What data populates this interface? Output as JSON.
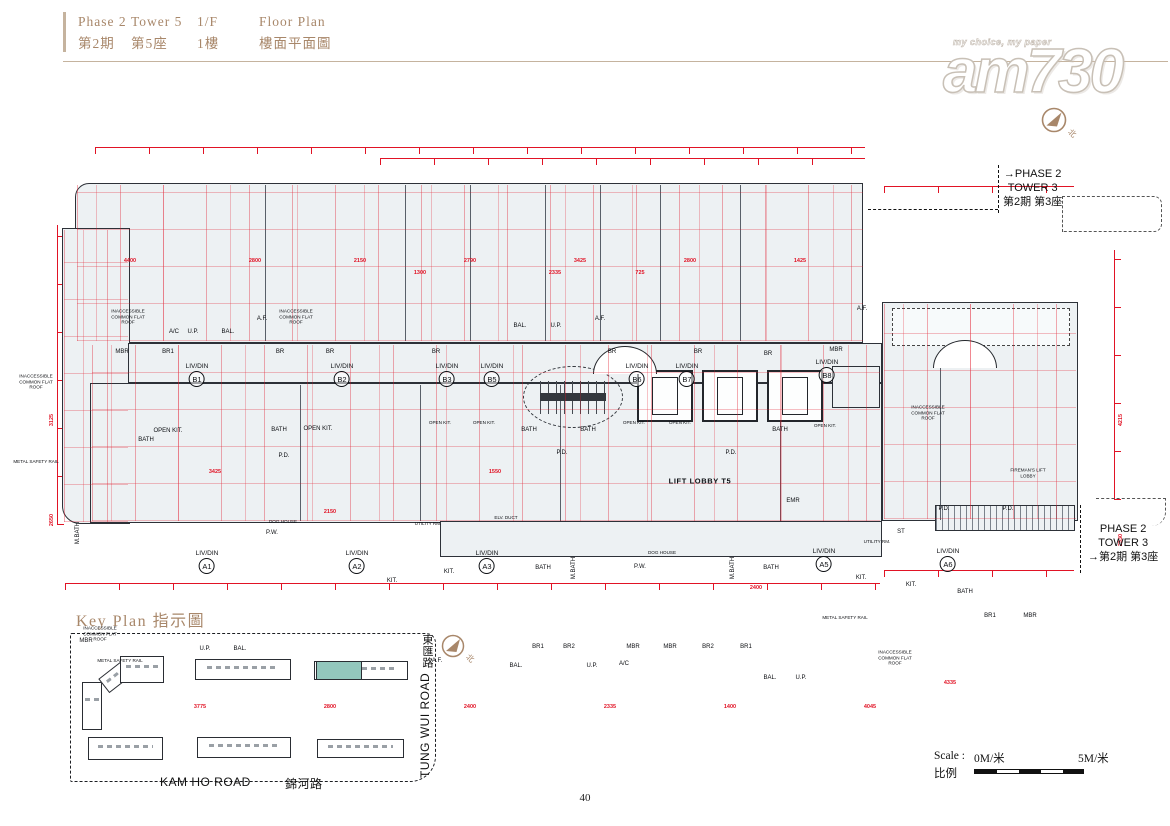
{
  "header": {
    "phase_en": "Phase 2",
    "tower_en": "Tower 5",
    "floor_en": "1/F",
    "plan_en": "Floor Plan",
    "phase_zh": "第2期",
    "tower_zh": "第5座",
    "floor_zh": "1樓",
    "plan_zh": "樓面平面圖"
  },
  "watermark": {
    "tagline": "my choice, my paper",
    "logo": "am730"
  },
  "compass": {
    "north": "北"
  },
  "plan": {
    "callout_top": {
      "l1": "PHASE 2",
      "l2": "TOWER 3",
      "l3": "第2期 第3座"
    },
    "callout_bottom": {
      "l1": "PHASE 2",
      "l2": "TOWER 3",
      "l3": "第2期 第3座"
    },
    "units": [
      {
        "r": "LIV/DIN",
        "id": "B1",
        "x": 197,
        "y": 243
      },
      {
        "r": "LIV/DIN",
        "id": "B2",
        "x": 342,
        "y": 243
      },
      {
        "r": "LIV/DIN",
        "id": "B3",
        "x": 447,
        "y": 243
      },
      {
        "r": "LIV/DIN",
        "id": "B5",
        "x": 492,
        "y": 243
      },
      {
        "r": "LIV/DIN",
        "id": "B6",
        "x": 637,
        "y": 243
      },
      {
        "r": "LIV/DIN",
        "id": "B7",
        "x": 687,
        "y": 243
      },
      {
        "r": "LIV/DIN",
        "id": "B8",
        "x": 827,
        "y": 239
      },
      {
        "r": "LIV/DIN",
        "id": "A1",
        "x": 207,
        "y": 430
      },
      {
        "r": "LIV/DIN",
        "id": "A2",
        "x": 357,
        "y": 430
      },
      {
        "r": "LIV/DIN",
        "id": "A3",
        "x": 487,
        "y": 430
      },
      {
        "r": "LIV/DIN",
        "id": "A5",
        "x": 824,
        "y": 428
      },
      {
        "r": "LIV/DIN",
        "id": "A6",
        "x": 948,
        "y": 428
      }
    ],
    "rooms": [
      {
        "t": "INACCESSIBLE COMMON FLAT ROOF",
        "x": 128,
        "y": 197,
        "c": "w"
      },
      {
        "t": "INACCESSIBLE COMMON FLAT ROOF",
        "x": 296,
        "y": 197,
        "c": "w"
      },
      {
        "t": "INACCESSIBLE COMMON FLAT ROOF",
        "x": 36,
        "y": 262,
        "c": "w"
      },
      {
        "t": "INACCESSIBLE COMMON FLAT ROOF",
        "x": 928,
        "y": 293,
        "c": "w"
      },
      {
        "t": "INACCESSIBLE COMMON FLAT ROOF",
        "x": 100,
        "y": 514,
        "c": "w"
      },
      {
        "t": "INACCESSIBLE COMMON FLAT ROOF",
        "x": 895,
        "y": 538,
        "c": "w"
      },
      {
        "t": "METAL SAFETY RAIL",
        "x": 36,
        "y": 342,
        "c": "w"
      },
      {
        "t": "METAL SAFETY RAIL",
        "x": 120,
        "y": 541,
        "c": "w"
      },
      {
        "t": "METAL SAFETY RAIL",
        "x": 845,
        "y": 498,
        "c": "w"
      },
      {
        "t": "A.F.",
        "x": 262,
        "y": 199
      },
      {
        "t": "A.F.",
        "x": 600,
        "y": 199
      },
      {
        "t": "A.F.",
        "x": 862,
        "y": 189
      },
      {
        "t": "A.F.",
        "x": 437,
        "y": 541
      },
      {
        "t": "A/C",
        "x": 174,
        "y": 212
      },
      {
        "t": "U.P.",
        "x": 193,
        "y": 212
      },
      {
        "t": "BAL.",
        "x": 228,
        "y": 212
      },
      {
        "t": "BAL.",
        "x": 520,
        "y": 206
      },
      {
        "t": "U.P.",
        "x": 556,
        "y": 206
      },
      {
        "t": "MBR",
        "x": 122,
        "y": 232
      },
      {
        "t": "BR1",
        "x": 168,
        "y": 232
      },
      {
        "t": "BR",
        "x": 280,
        "y": 232
      },
      {
        "t": "BR",
        "x": 330,
        "y": 232
      },
      {
        "t": "BR",
        "x": 436,
        "y": 232
      },
      {
        "t": "BR",
        "x": 612,
        "y": 232
      },
      {
        "t": "BR",
        "x": 698,
        "y": 232
      },
      {
        "t": "BR",
        "x": 768,
        "y": 234
      },
      {
        "t": "MBR",
        "x": 836,
        "y": 230
      },
      {
        "t": "OPEN KIT.",
        "x": 168,
        "y": 311
      },
      {
        "t": "OPEN KIT.",
        "x": 318,
        "y": 309
      },
      {
        "t": "OPEN KIT.",
        "x": 440,
        "y": 303,
        "c": "w"
      },
      {
        "t": "OPEN KIT.",
        "x": 484,
        "y": 303,
        "c": "w"
      },
      {
        "t": "OPEN KIT.",
        "x": 634,
        "y": 303,
        "c": "w"
      },
      {
        "t": "OPEN KIT.",
        "x": 680,
        "y": 303,
        "c": "w"
      },
      {
        "t": "OPEN KIT.",
        "x": 825,
        "y": 306,
        "c": "w"
      },
      {
        "t": "BATH",
        "x": 146,
        "y": 320
      },
      {
        "t": "BATH",
        "x": 279,
        "y": 310
      },
      {
        "t": "BATH",
        "x": 529,
        "y": 310
      },
      {
        "t": "BATH",
        "x": 588,
        "y": 310
      },
      {
        "t": "BATH",
        "x": 780,
        "y": 310
      },
      {
        "t": "P.D.",
        "x": 284,
        "y": 336
      },
      {
        "t": "P.D.",
        "x": 562,
        "y": 333
      },
      {
        "t": "P.D.",
        "x": 731,
        "y": 333
      },
      {
        "t": "P.D.",
        "x": 944,
        "y": 389
      },
      {
        "t": "P.D.",
        "x": 1008,
        "y": 389
      },
      {
        "t": "LIFT LOBBY T5",
        "x": 700,
        "y": 361,
        "c": "b"
      },
      {
        "t": "FIREMAN'S LIFT LOBBY",
        "x": 1028,
        "y": 353,
        "c": "w"
      },
      {
        "t": "ELV. DUCT",
        "x": 506,
        "y": 398,
        "c": "w"
      },
      {
        "t": "EMR",
        "x": 793,
        "y": 381
      },
      {
        "t": "DOG HOUSE",
        "x": 662,
        "y": 433,
        "c": "w"
      },
      {
        "t": "P.W.",
        "x": 640,
        "y": 447
      },
      {
        "t": "DOG HOUSE",
        "x": 283,
        "y": 402,
        "c": "w"
      },
      {
        "t": "P.W.",
        "x": 272,
        "y": 413
      },
      {
        "t": "BATH",
        "x": 543,
        "y": 448
      },
      {
        "t": "M.BATH",
        "x": 574,
        "y": 448,
        "c": "v"
      },
      {
        "t": "M.BATH",
        "x": 733,
        "y": 448,
        "c": "v"
      },
      {
        "t": "BATH",
        "x": 771,
        "y": 448
      },
      {
        "t": "M.BATH",
        "x": 78,
        "y": 413,
        "c": "v"
      },
      {
        "t": "KIT.",
        "x": 392,
        "y": 461
      },
      {
        "t": "KIT.",
        "x": 449,
        "y": 452
      },
      {
        "t": "KIT.",
        "x": 861,
        "y": 458
      },
      {
        "t": "KIT.",
        "x": 911,
        "y": 465
      },
      {
        "t": "UTILITY RM.",
        "x": 428,
        "y": 404,
        "c": "w"
      },
      {
        "t": "UTILITY RM.",
        "x": 877,
        "y": 422,
        "c": "w"
      },
      {
        "t": "ST",
        "x": 901,
        "y": 412
      },
      {
        "t": "BATH",
        "x": 965,
        "y": 472
      },
      {
        "t": "MBR",
        "x": 86,
        "y": 521
      },
      {
        "t": "BR1",
        "x": 538,
        "y": 527
      },
      {
        "t": "BR2",
        "x": 569,
        "y": 527
      },
      {
        "t": "MBR",
        "x": 633,
        "y": 527
      },
      {
        "t": "MBR",
        "x": 670,
        "y": 527
      },
      {
        "t": "BR2",
        "x": 708,
        "y": 527
      },
      {
        "t": "BR1",
        "x": 746,
        "y": 527
      },
      {
        "t": "BR1",
        "x": 990,
        "y": 496
      },
      {
        "t": "MBR",
        "x": 1030,
        "y": 496
      },
      {
        "t": "U.P.",
        "x": 205,
        "y": 529
      },
      {
        "t": "BAL.",
        "x": 240,
        "y": 529
      },
      {
        "t": "BAL.",
        "x": 516,
        "y": 546
      },
      {
        "t": "U.P.",
        "x": 592,
        "y": 546
      },
      {
        "t": "A/C",
        "x": 624,
        "y": 544
      },
      {
        "t": "BAL.",
        "x": 770,
        "y": 558
      },
      {
        "t": "U.P.",
        "x": 801,
        "y": 558
      }
    ],
    "dims": [
      {
        "v": "4400",
        "x": 130,
        "y": 141
      },
      {
        "v": "2800",
        "x": 255,
        "y": 141
      },
      {
        "v": "2150",
        "x": 360,
        "y": 141
      },
      {
        "v": "2790",
        "x": 470,
        "y": 141
      },
      {
        "v": "3425",
        "x": 580,
        "y": 141
      },
      {
        "v": "2800",
        "x": 690,
        "y": 141
      },
      {
        "v": "1425",
        "x": 800,
        "y": 141
      },
      {
        "v": "1300",
        "x": 420,
        "y": 153
      },
      {
        "v": "2335",
        "x": 555,
        "y": 153
      },
      {
        "v": "725",
        "x": 640,
        "y": 153
      },
      {
        "v": "3775",
        "x": 200,
        "y": 587
      },
      {
        "v": "2800",
        "x": 330,
        "y": 587
      },
      {
        "v": "2400",
        "x": 470,
        "y": 587
      },
      {
        "v": "2335",
        "x": 610,
        "y": 587
      },
      {
        "v": "1400",
        "x": 730,
        "y": 587
      },
      {
        "v": "4045",
        "x": 870,
        "y": 587
      },
      {
        "v": "4335",
        "x": 950,
        "y": 563
      },
      {
        "v": "3125",
        "x": 52,
        "y": 300,
        "c": "vd"
      },
      {
        "v": "2650",
        "x": 52,
        "y": 400,
        "c": "vd"
      },
      {
        "v": "4215",
        "x": 1121,
        "y": 300,
        "c": "vd"
      },
      {
        "v": "2330",
        "x": 1121,
        "y": 420,
        "c": "vd"
      },
      {
        "v": "2150",
        "x": 330,
        "y": 392
      },
      {
        "v": "3425",
        "x": 215,
        "y": 352
      },
      {
        "v": "2400",
        "x": 756,
        "y": 468
      },
      {
        "v": "1550",
        "x": 495,
        "y": 352
      }
    ]
  },
  "key_plan": {
    "title": "Key Plan 指示圖",
    "road_bottom_en": "KAM HO ROAD",
    "road_bottom_zh": "錦河路",
    "road_right_en": "TUNG WUI ROAD",
    "road_right_zh": "東匯路"
  },
  "scale": {
    "label_en": "Scale :",
    "label_zh": "比例",
    "min": "0M/米",
    "max": "5M/米"
  },
  "page_number": "40",
  "colors": {
    "accent": "#a8876a",
    "red": "#e11325",
    "teal": "#93c7bd"
  }
}
